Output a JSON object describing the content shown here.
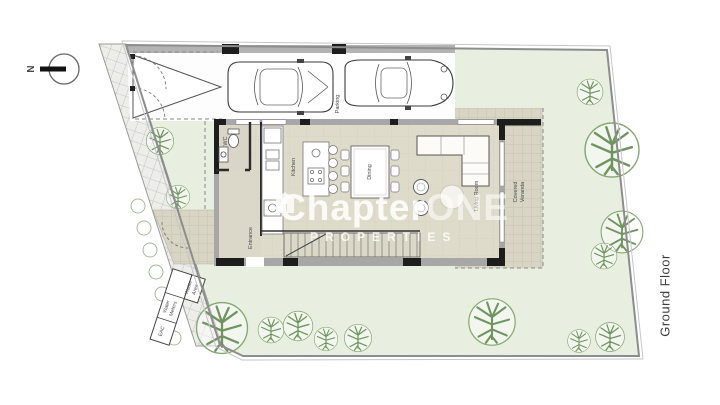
{
  "floor_label": "Ground Floor",
  "north": {
    "label": "N"
  },
  "watermark": {
    "brand_a": "Chapter",
    "brand_b": "ONE",
    "subtitle": "PROPERTIES"
  },
  "rooms": {
    "parking": "Parking",
    "wc": "WC",
    "kitchen": "Kitchen",
    "dining": "Dining",
    "living_room": "Living Room",
    "covered_veranda_line1": "Covered",
    "covered_veranda_line2": "Veranda",
    "entrance": "Entrance"
  },
  "site_labels": {
    "waste_area_line1": "Waste",
    "waste_area_line2": "Area",
    "water_meters_line1": "Water",
    "water_meters_line2": "Meters",
    "eac": "EAC"
  },
  "colors": {
    "lawn": "#e8efe1",
    "tree_line": "#6f9460",
    "tile": "#d8d5c4",
    "floor": "#dfdbcb",
    "wall_dark": "#222222",
    "wall_gray": "#a7a7a7",
    "boundary": "#8d8d8d",
    "watermark_text": "rgba(255,255,255,0.85)"
  }
}
